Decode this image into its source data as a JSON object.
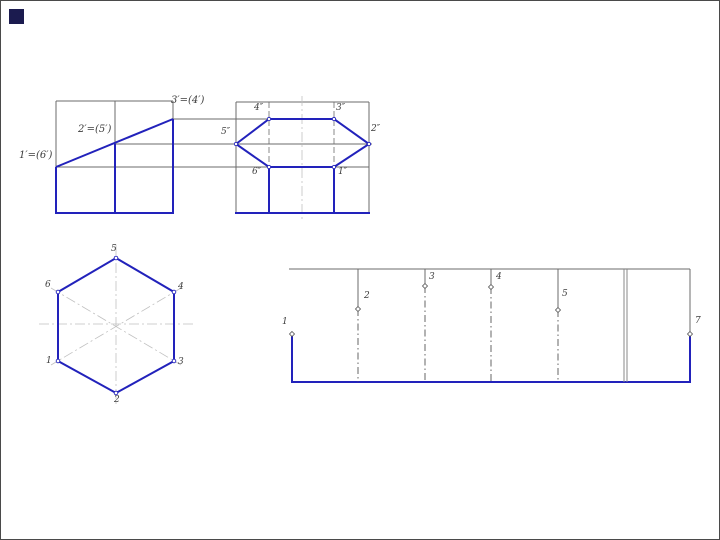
{
  "slide": {
    "description": "Descriptive geometry drawing: truncated hexagonal prism — front view, profile view with hexagon, true-shape hexagon, and surface development"
  },
  "front_view": {
    "labels": [
      "1′=(6′)",
      "2′=(5′)",
      "3′=(4′)"
    ]
  },
  "profile_view": {
    "labels": [
      "5″",
      "4″",
      "3″",
      "2″",
      "6″",
      "1″"
    ]
  },
  "hexagon_view": {
    "labels": [
      "5",
      "6",
      "4",
      "1",
      "3",
      "2"
    ]
  },
  "development_view": {
    "labels": [
      "1",
      "2",
      "3",
      "4",
      "5",
      "7"
    ]
  },
  "colors": {
    "line_blue": "#2222bb",
    "construction_gray": "#6b6b6b",
    "centerline_gray": "#c0c0c0",
    "bullet_navy": "#1b1b4f"
  }
}
